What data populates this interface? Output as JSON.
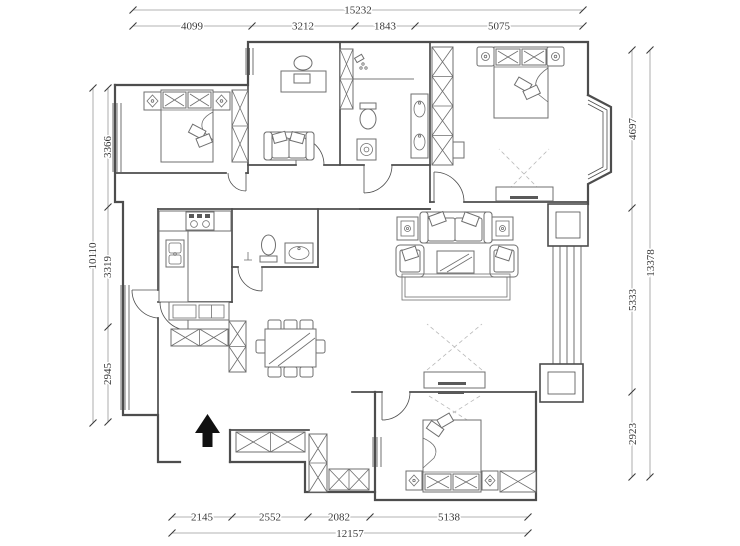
{
  "drawing": {
    "kind": "apartment floor plan",
    "units": "millimeters"
  },
  "colors": {
    "wall": "#4d4d4d",
    "furn": "#6f6f6f",
    "dim": "#9a9a9a",
    "text": "#3a3a3a",
    "arrow": "#111111",
    "bg": "#ffffff"
  },
  "dimensions": {
    "top": {
      "total": "15232",
      "segments": [
        "4099",
        "3212",
        "1843",
        "5075"
      ]
    },
    "left": {
      "total": "10110",
      "segments": [
        "3366",
        "3319",
        "2945"
      ]
    },
    "right": {
      "total": "13378",
      "segments": [
        "4697",
        "5333",
        "2923"
      ]
    },
    "bottom": {
      "total": "12157",
      "segments": [
        "2145",
        "2552",
        "2082",
        "5138"
      ]
    }
  }
}
